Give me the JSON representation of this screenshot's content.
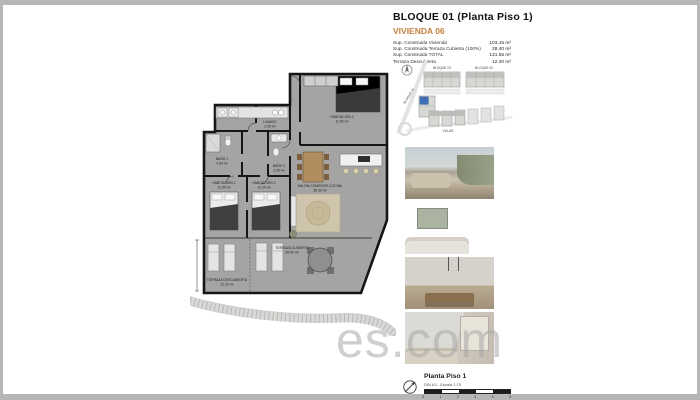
{
  "page": {
    "watermark": "es.com"
  },
  "header": {
    "title": "BLOQUE 01  (Planta Piso 1)",
    "subtitle": "VIVIENDA 06",
    "accent_color": "#c5803c",
    "areas": [
      {
        "label": "Sup. Construida Vivienda",
        "value": "103.15 m²"
      },
      {
        "label": "Sup. Construida Terraza Cubierta (100%)",
        "value": "28.40 m²"
      },
      {
        "label": "Sup. Construida TOTAL",
        "value": "131.55 m²"
      },
      {
        "label": "Terraza Descubierta",
        "value": "12.20 m²"
      }
    ]
  },
  "sitemap": {
    "labels": {
      "top_left": "BLOQUE 03",
      "top_right": "BLOQUE 02",
      "left": "BLOQUE 01",
      "bottom": "VILLAS"
    },
    "highlight_color": "#3f6db4"
  },
  "floorplan": {
    "rooms": [
      {
        "name": "HABITACIÓN 3",
        "area": "11.50 m²"
      },
      {
        "name": "LAVADO",
        "area": "2.05 m²"
      },
      {
        "name": "BAÑO 1",
        "area": "4.50 m²"
      },
      {
        "name": "BAÑO 2",
        "area": "3.55 m²"
      },
      {
        "name": "HABITACIÓN 1",
        "area": "11.90 m²"
      },
      {
        "name": "HABITACIÓN 2",
        "area": "10.20 m²"
      },
      {
        "name": "SALÓN-COMEDOR-COCINA",
        "area": "36.30 m²"
      },
      {
        "name": "TERRAZA CUBIERTA",
        "area": "28.40 m²"
      },
      {
        "name": "TERRAZA DESCUBIERTA",
        "area": "12.20 m²"
      }
    ]
  },
  "photos": [
    {
      "name": "terraza-render"
    },
    {
      "name": "salon-render"
    },
    {
      "name": "comedor-render"
    },
    {
      "name": "dormitorio-render"
    }
  ],
  "footer": {
    "plan_name": "Planta Piso 1",
    "scale_note": "DIN A3 - Escala 1:75",
    "scale_ticks": [
      "0",
      "1",
      "2",
      "3",
      "4",
      "5"
    ]
  }
}
